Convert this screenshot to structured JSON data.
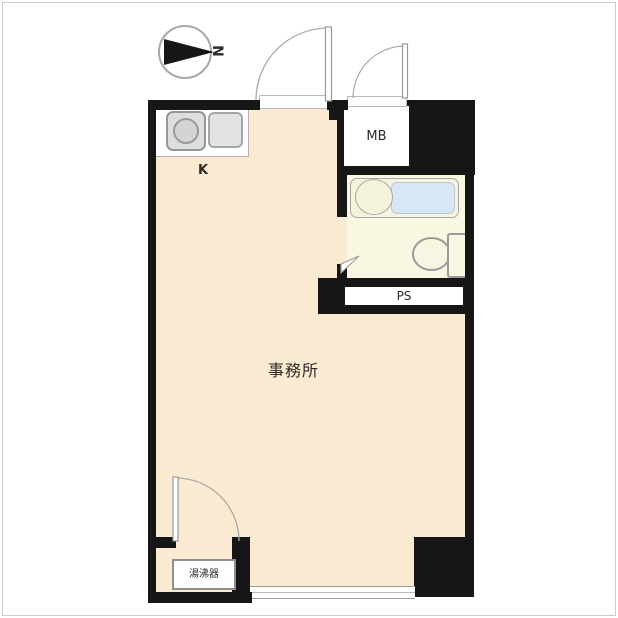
{
  "title": "事務所 間取り図 (office unit floor plan)",
  "colors": {
    "bg": "#ffffff",
    "wall": "#161616",
    "floor": "#faead2",
    "bath-floor": "#f9f6e2",
    "tub": "#d7e7f3",
    "line": "#9a9a9a",
    "text": "#2e2a26"
  },
  "compass": {
    "label": "N"
  },
  "rooms": {
    "office": "事務所",
    "kitchen": "K"
  },
  "fixtures": {
    "meter_box": "MB",
    "pipe_space": "PS",
    "water_heater": "湯沸器"
  }
}
